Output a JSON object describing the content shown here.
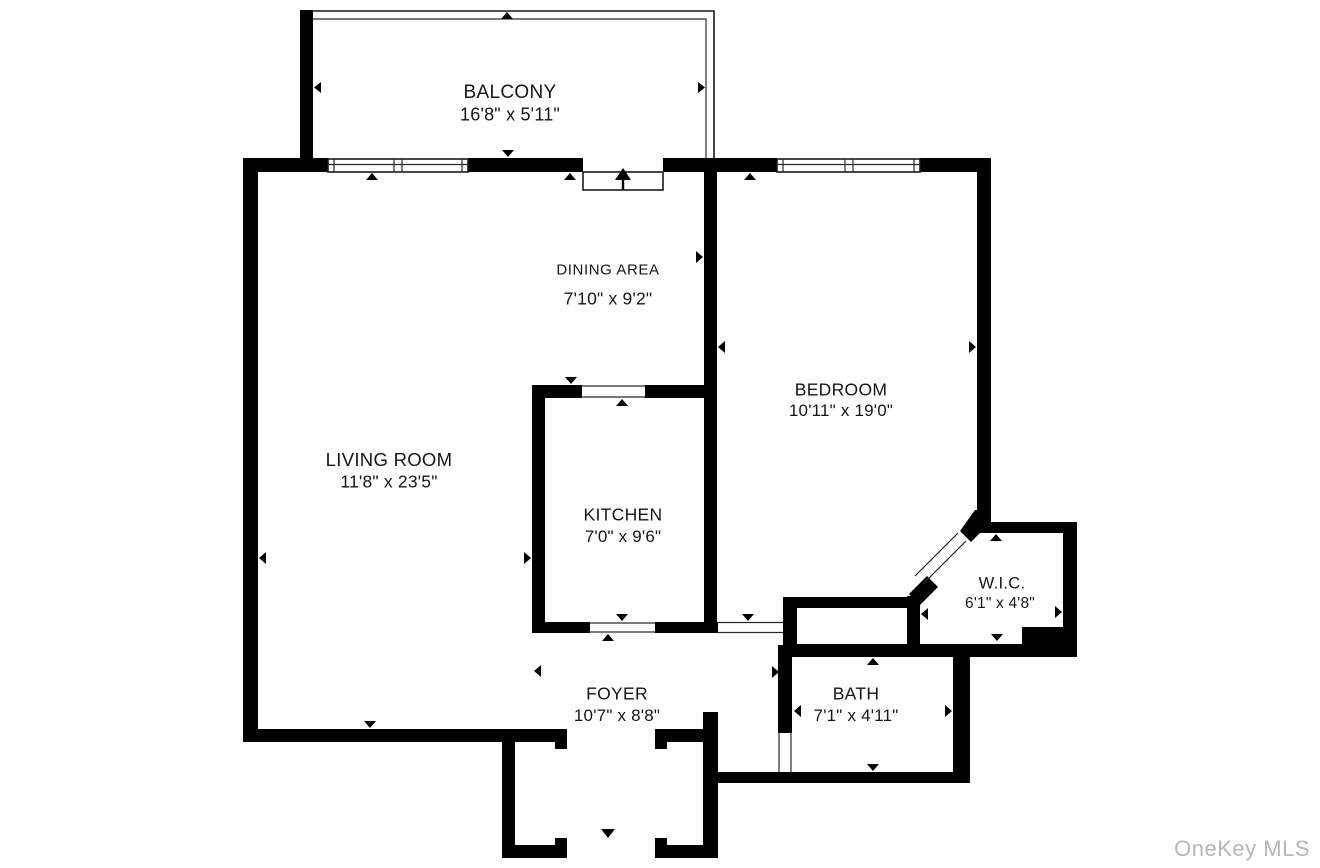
{
  "floor_plan": {
    "title": "Apartment floor plan",
    "rooms": [
      {
        "id": "balcony",
        "name": "BALCONY",
        "dimensions": "16'8\" x 5'11\""
      },
      {
        "id": "dining",
        "name": "DINING AREA",
        "dimensions": "7'10\" x 9'2\""
      },
      {
        "id": "living",
        "name": "LIVING ROOM",
        "dimensions": "11'8\" x 23'5\""
      },
      {
        "id": "kitchen",
        "name": "KITCHEN",
        "dimensions": "7'0\" x 9'6\""
      },
      {
        "id": "bedroom",
        "name": "BEDROOM",
        "dimensions": "10'11\" x 19'0\""
      },
      {
        "id": "wic",
        "name": "W.I.C.",
        "dimensions": "6'1\" x 4'8\""
      },
      {
        "id": "foyer",
        "name": "FOYER",
        "dimensions": "10'7\" x 8'8\""
      },
      {
        "id": "bath",
        "name": "BATH",
        "dimensions": "7'1\" x 4'11\""
      }
    ],
    "watermark": "OneKey MLS",
    "colors": {
      "wall": "#000000",
      "background": "#ffffff",
      "watermark": "#b5b7b9"
    }
  }
}
